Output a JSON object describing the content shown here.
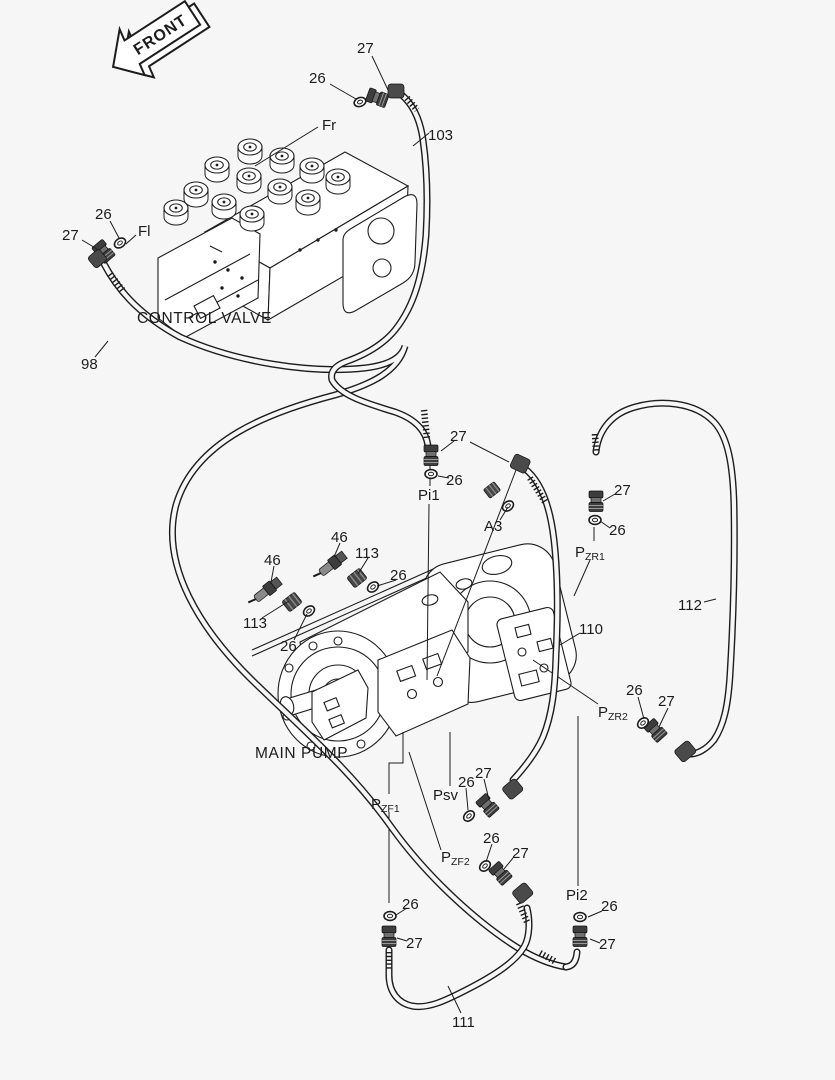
{
  "colors": {
    "background": "#f6f6f6",
    "ink": "#1c1c1c",
    "metal_dark": "#3c3c3c",
    "metal_mid": "#6e6e6e",
    "paper": "#ffffff"
  },
  "front_arrow": {
    "label": "FRONT"
  },
  "components": {
    "control_valve": "CONTROL VALVE",
    "main_pump": "MAIN PUMP"
  },
  "parts": {
    "oring": "26",
    "nipple": "27",
    "sensor": "46",
    "connector": "113",
    "hose_fl_pi2": "98",
    "hose_fr_pi1": "103",
    "hose_a3_psv": "110",
    "hose_zf": "111",
    "hose_zr": "112"
  },
  "ports": {
    "fr": "Fr",
    "fl": "Fl",
    "pi1": "Pi1",
    "pi2": "Pi2",
    "a3": "A3",
    "psv": "Psv",
    "pzr1_main": "P",
    "pzr1_sub": "ZR1",
    "pzr2_main": "P",
    "pzr2_sub": "ZR2",
    "pzf1_main": "P",
    "pzf1_sub": "ZF1",
    "pzf2_main": "P",
    "pzf2_sub": "ZF2"
  }
}
